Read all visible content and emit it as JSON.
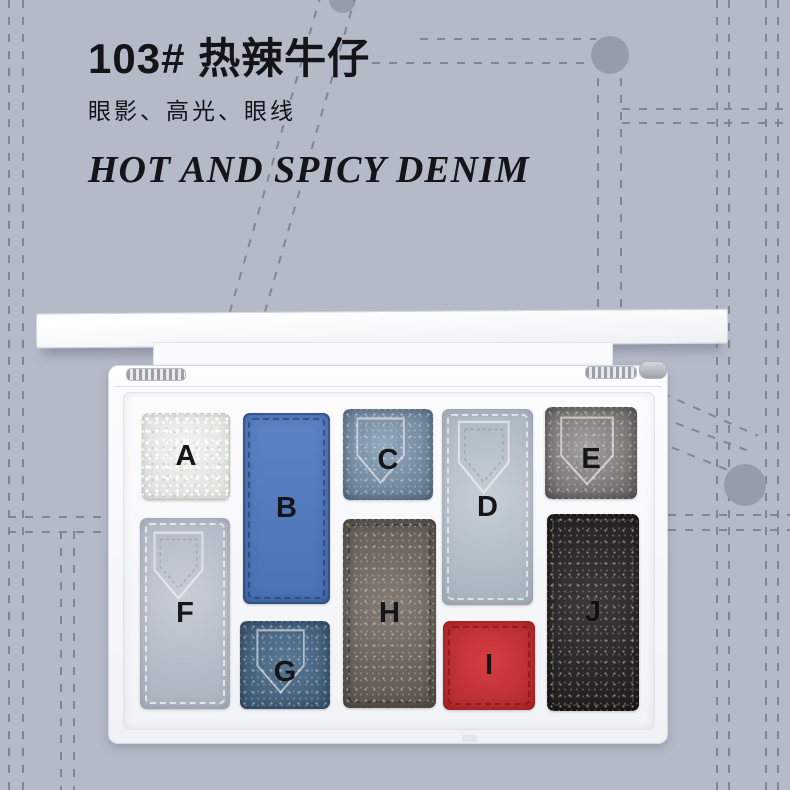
{
  "header": {
    "title": "103# 热辣牛仔",
    "subtitle": "眼影、高光、眼线",
    "title_en": "HOT AND SPICY DENIM"
  },
  "palette": {
    "description": "open white eyeshadow palette with ten denim-themed pans labelled A to J",
    "pans": [
      {
        "letter": "A",
        "color": "#ecefe9",
        "finish": "white glitter"
      },
      {
        "letter": "B",
        "color": "#4f76b8",
        "finish": "matte denim blue"
      },
      {
        "letter": "C",
        "color": "#8ba2b6",
        "finish": "shimmer light denim",
        "pocket_emboss": true
      },
      {
        "letter": "D",
        "color": "#bec8d0",
        "finish": "matte pale grey-blue",
        "pocket_emboss": true
      },
      {
        "letter": "E",
        "color": "#94918e",
        "finish": "shimmer grey",
        "pocket_emboss": true
      },
      {
        "letter": "F",
        "color": "#bfc5cf",
        "finish": "matte light grey",
        "pocket_emboss": true
      },
      {
        "letter": "G",
        "color": "#4e6e8d",
        "finish": "shimmer dark denim",
        "pocket_emboss": true
      },
      {
        "letter": "H",
        "color": "#7a716a",
        "finish": "shimmer taupe"
      },
      {
        "letter": "I",
        "color": "#cc373c",
        "finish": "matte red"
      },
      {
        "letter": "J",
        "color": "#343230",
        "finish": "shimmer black"
      }
    ]
  },
  "colors": {
    "background": "#b4bac7",
    "stitch_dash": "#7e8798",
    "rivet": "#959cab",
    "text": "#15151a"
  }
}
